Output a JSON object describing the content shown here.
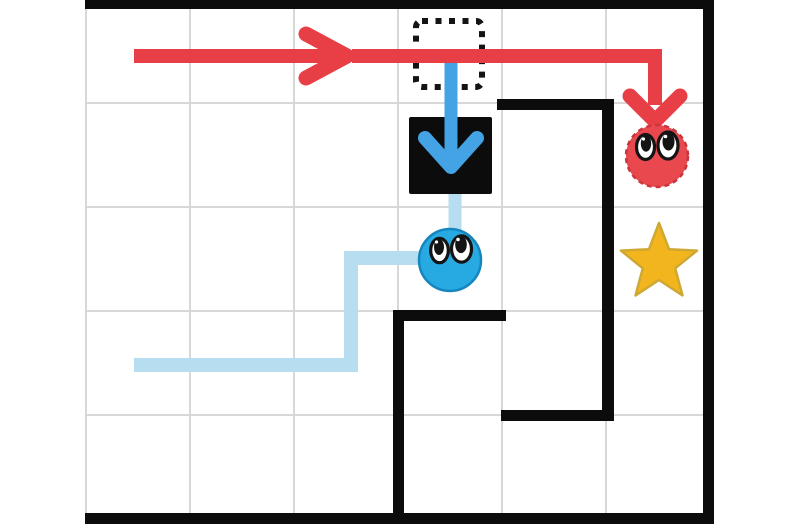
{
  "app": {
    "name": "ball-maze-puzzle",
    "view": "level-board"
  },
  "board": {
    "columns": 6,
    "rows": 5,
    "description": "White grid maze, open left edge, black border walls on top, right and bottom, two L-shaped interior walls"
  },
  "colors": {
    "red": "#e83f47",
    "red_ball": "#e8484e",
    "red_ball_edge": "#c8353d",
    "blue_arrow": "#43a3e5",
    "trail": "#b7ddf0",
    "blue_ball": "#27a9e2",
    "blue_ball_edge": "#1585bd",
    "star": "#f3b51e",
    "star_edge": "#cfa833",
    "wall": "#0c0c0c",
    "grid": "#d8d8d8",
    "eye_white": "#ffffff",
    "ink": "#141414"
  },
  "entities": [
    {
      "id": "red-ball",
      "label": "red ball character with eyes",
      "cell": {
        "col": 6,
        "row": 2
      }
    },
    {
      "id": "blue-ball",
      "label": "blue ball character with eyes",
      "cell": {
        "col": 4,
        "row": 3
      }
    },
    {
      "id": "star",
      "label": "gold star goal",
      "cell": {
        "col": 6,
        "row": 3
      }
    },
    {
      "id": "black-square",
      "label": "solid black block",
      "cell": {
        "col": 4,
        "row": 2
      }
    },
    {
      "id": "dotted-square",
      "label": "dotted outline slot",
      "cell": {
        "col": 4,
        "row": 1
      }
    }
  ],
  "paths": [
    {
      "id": "red-path",
      "color_ref": "red",
      "route": "from col 1 row 1 rightwards across the top row, then down into col 6 row 2 toward the red ball",
      "arrowheads": [
        "right-pointing chevron near col 3/4 boundary",
        "down-pointing chevron above red ball"
      ]
    },
    {
      "id": "blue-arrow",
      "color_ref": "blue_arrow",
      "route": "from the red path at col 4 row 1 straight down into the black square",
      "arrowheads": [
        "down-pointing chevron inside black square"
      ]
    },
    {
      "id": "blue-trail",
      "color_ref": "trail",
      "route": "from col 1 row 4 rightwards, up into row 3, right to the blue ball, and from the blue ball up to the black square"
    }
  ]
}
